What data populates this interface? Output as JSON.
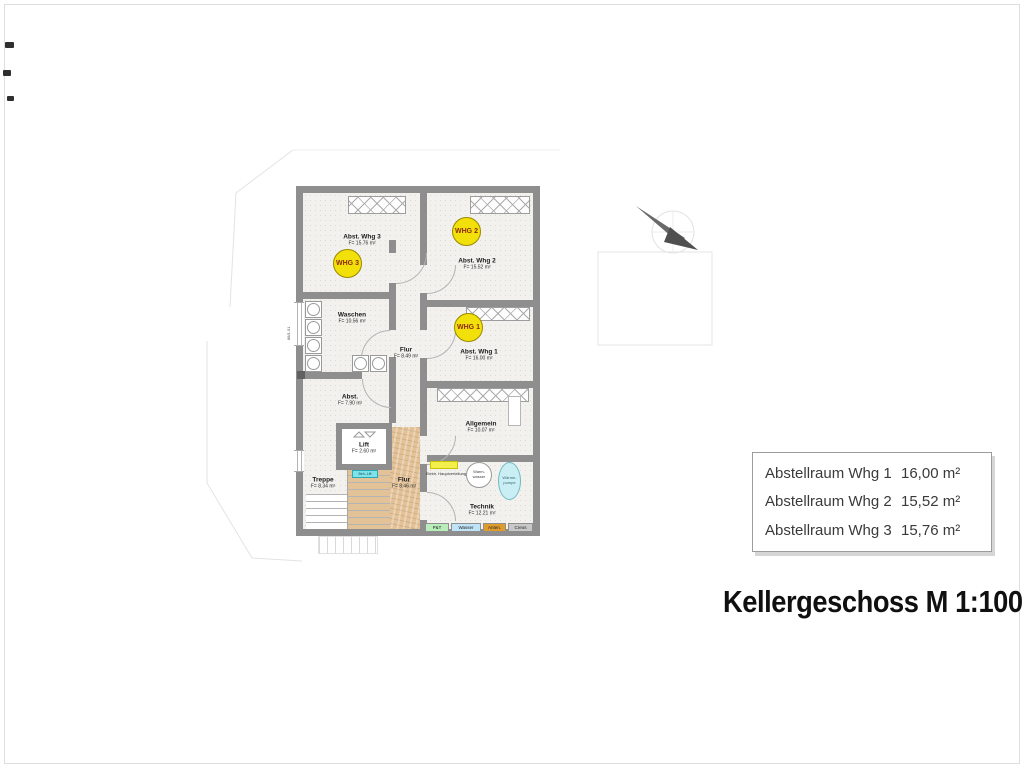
{
  "title": "Kellergeschoss M 1:100",
  "rooms": [
    {
      "id": "abst-whg-3",
      "name": "Abst. Whg 3",
      "area": "F= 15.76 m²"
    },
    {
      "id": "abst-whg-2",
      "name": "Abst. Whg 2",
      "area": "F= 15.52 m²"
    },
    {
      "id": "waschen",
      "name": "Waschen",
      "area": "F= 10.56 m²"
    },
    {
      "id": "flur-oben",
      "name": "Flur",
      "area": "F= 8.49 m²"
    },
    {
      "id": "abst-whg-1",
      "name": "Abst. Whg 1",
      "area": "F= 16.00 m²"
    },
    {
      "id": "abst",
      "name": "Abst.",
      "area": "F= 7.90 m²"
    },
    {
      "id": "lift",
      "name": "Lift",
      "area": "F= 2.60 m²"
    },
    {
      "id": "treppe",
      "name": "Treppe",
      "area": "F= 8.34 m²"
    },
    {
      "id": "flur-unten",
      "name": "Flur",
      "area": "F= 8.46 m²"
    },
    {
      "id": "allgemein",
      "name": "Allgemein",
      "area": "F= 10.07 m²"
    },
    {
      "id": "technik",
      "name": "Technik",
      "area": "F= 12.21 m²"
    }
  ],
  "badges": [
    "WHG 3",
    "WHG 2",
    "WHG 1"
  ],
  "technik": {
    "elektro_label": "Elektr. Hauptverteilung",
    "warmwasser": {
      "line1": "Warm-",
      "line2": "wasser"
    },
    "waermepumpe": {
      "line1": "Wärme-",
      "line2": "pumpe"
    },
    "utilities": [
      {
        "label": "P&T",
        "color": "#b9eebb"
      },
      {
        "label": "Wasser",
        "color": "#bfe3f7"
      },
      {
        "label": "Anten.",
        "color": "#e09b2d"
      },
      {
        "label": "Creos",
        "color": "#c8c8c8"
      }
    ]
  },
  "lift_marker": "Beh.-Lift",
  "window_dim": "88/1.01",
  "summary_table": {
    "rows": [
      {
        "label": "Abstellraum Whg 1",
        "value": "16,00 m²"
      },
      {
        "label": "Abstellraum Whg 2",
        "value": "15,52 m²"
      },
      {
        "label": "Abstellraum Whg 3",
        "value": "15,76 m²"
      }
    ]
  },
  "colors": {
    "wall_gray": "#8e8e8e",
    "badge_yellow": "#f2e00a",
    "badge_text_red": "#8d2a12",
    "wood_tan": "#e3c298",
    "elektro_yellow": "#f3ef4e",
    "marker_cyan": "#7fe3e8",
    "heatpump_cyan": "#c9eef3"
  }
}
